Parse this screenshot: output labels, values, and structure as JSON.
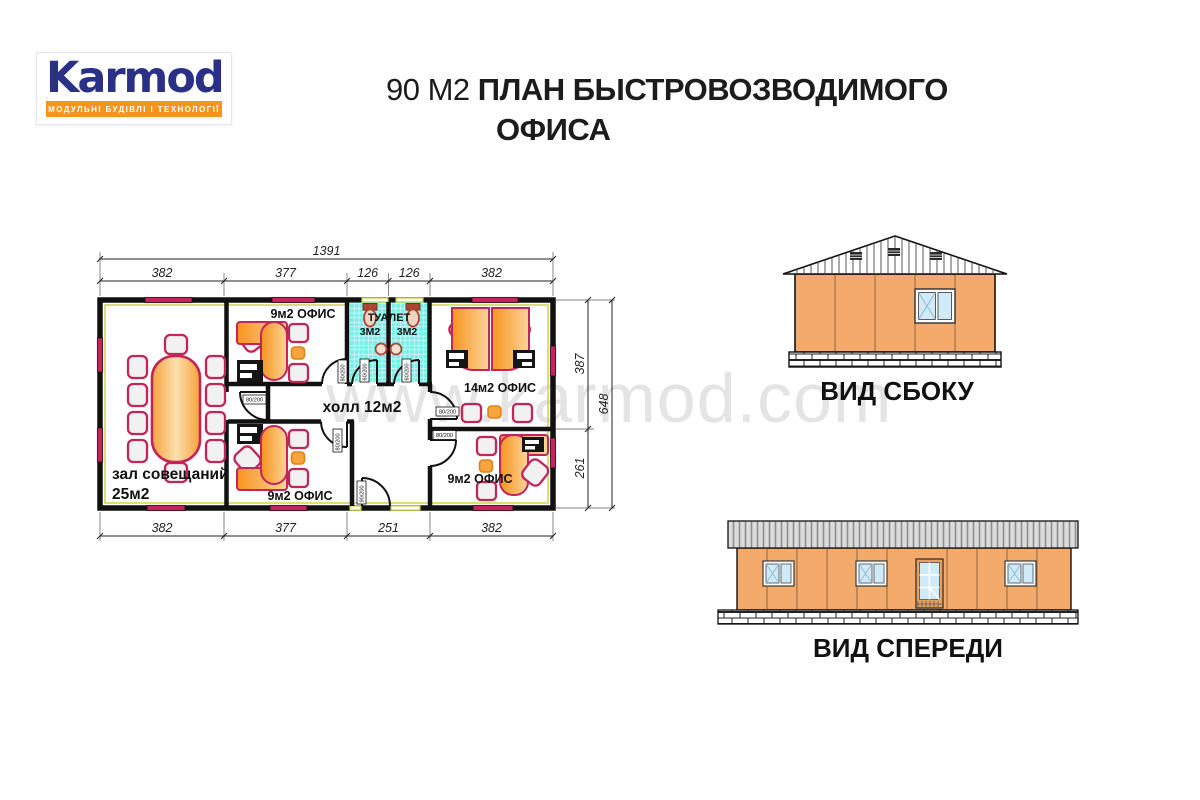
{
  "logo": {
    "name": "Karmod",
    "tagline": "МОДУЛЬНІ БУДІВЛІ І ТЕХНОЛОГІЇ"
  },
  "title": {
    "area": "90 M2",
    "line1": "ПЛАН БЫСТРОВОЗВОДИМОГО",
    "line2": "ОФИСА"
  },
  "watermark": "www.karmod.com",
  "plan": {
    "dims": {
      "total_width": "1391",
      "top": [
        "382",
        "377",
        "126",
        "126",
        "382"
      ],
      "bottom": [
        "382",
        "377",
        "251",
        "382"
      ],
      "right": [
        "387",
        "261"
      ],
      "total_height": "648"
    },
    "rooms": {
      "meeting": "зал совещаний",
      "meeting_area": "25м2",
      "office9": "9м2 ОФИС",
      "office14": "14м2 ОФИС",
      "hall": "холл 12м2",
      "toilet": "ТУАЛЕТ",
      "toilet_area": "3М2"
    },
    "doors": {
      "d80": "80/200",
      "d60": "60/200",
      "d90": "90/200"
    }
  },
  "views": {
    "side": "ВИД СБОКУ",
    "front": "ВИД СПЕРЕДИ"
  },
  "colors": {
    "brand_blue": "#2B3087",
    "accent_orange": "#F7941E",
    "furniture_outline": "#C2255C",
    "desk_orange": "#F7941E",
    "wall_yellow": "#C6CC2F",
    "window_crimson": "#C2255C",
    "tile_cyan": "#7CF0E8",
    "panel_orange": "#F3AA6B",
    "glass_blue": "#CFEBF9"
  }
}
